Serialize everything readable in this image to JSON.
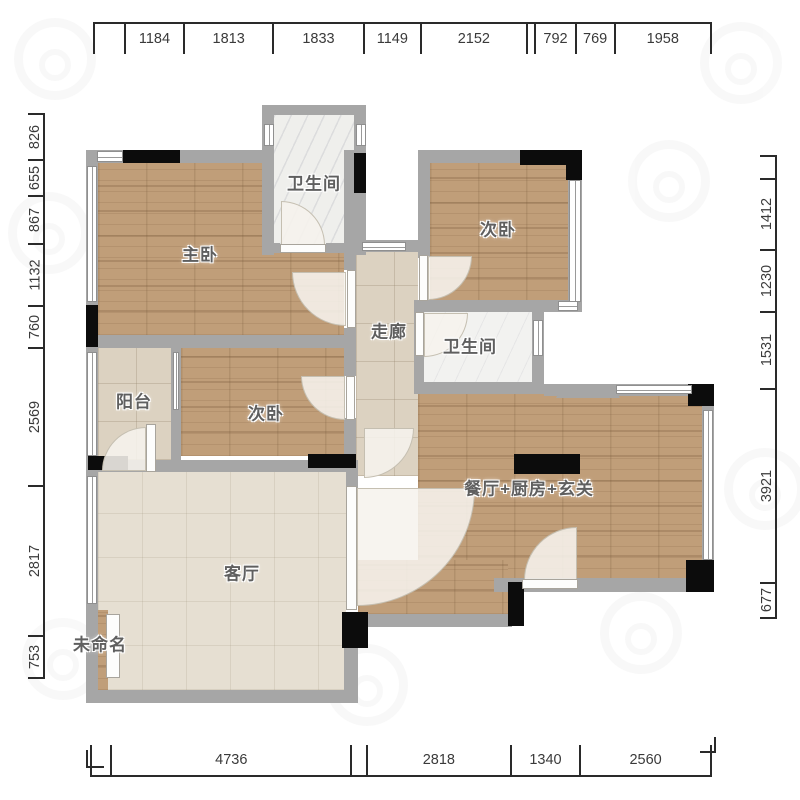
{
  "rooms": [
    {
      "id": "master-bedroom",
      "label": "主卧"
    },
    {
      "id": "bathroom-top",
      "label": "卫生间"
    },
    {
      "id": "bedroom-top-right",
      "label": "次卧"
    },
    {
      "id": "corridor",
      "label": "走廊"
    },
    {
      "id": "bathroom-middle",
      "label": "卫生间"
    },
    {
      "id": "balcony",
      "label": "阳台"
    },
    {
      "id": "bedroom-middle",
      "label": "次卧"
    },
    {
      "id": "dining-kitchen-foyer",
      "label": "餐厅+厨房+玄关"
    },
    {
      "id": "living-room",
      "label": "客厅"
    },
    {
      "id": "unnamed",
      "label": "未命名"
    }
  ],
  "dimensions_mm": {
    "top": [
      {
        "label": "",
        "mm": 600
      },
      {
        "label": "1184",
        "mm": 1184
      },
      {
        "label": "1813",
        "mm": 1813
      },
      {
        "label": "1833",
        "mm": 1833
      },
      {
        "label": "1149",
        "mm": 1149
      },
      {
        "label": "2152",
        "mm": 2152
      },
      {
        "label": "",
        "mm": 140
      },
      {
        "label": "792",
        "mm": 792
      },
      {
        "label": "769",
        "mm": 769
      },
      {
        "label": "1958",
        "mm": 1958
      }
    ],
    "bottom": [
      {
        "label": "",
        "mm": 360
      },
      {
        "label": "4736",
        "mm": 4736
      },
      {
        "label": "",
        "mm": 270
      },
      {
        "label": "2818",
        "mm": 2818
      },
      {
        "label": "1340",
        "mm": 1340
      },
      {
        "label": "2560",
        "mm": 2560
      }
    ],
    "left": [
      {
        "label": "826",
        "mm": 826
      },
      {
        "label": "655",
        "mm": 655
      },
      {
        "label": "867",
        "mm": 867
      },
      {
        "label": "1132",
        "mm": 1132
      },
      {
        "label": "760",
        "mm": 760
      },
      {
        "label": "2569",
        "mm": 2569
      },
      {
        "label": "2817",
        "mm": 2817
      },
      {
        "label": "753",
        "mm": 753
      }
    ],
    "right": [
      {
        "label": "",
        "mm": 420
      },
      {
        "label": "1412",
        "mm": 1412
      },
      {
        "label": "1230",
        "mm": 1230
      },
      {
        "label": "1531",
        "mm": 1531
      },
      {
        "label": "3921",
        "mm": 3921
      },
      {
        "label": "677",
        "mm": 677
      }
    ]
  },
  "colors": {
    "wall": "#a6a6a6",
    "column": "#0c0c0c",
    "wood_floor": "#c09e79",
    "tile_floor": "#dcd2c1",
    "living_floor": "#e6dfd2",
    "marble_floor": "#efefec",
    "dimension_line": "#2a2a2a"
  },
  "icons": {
    "watermark": "circle-logo"
  }
}
